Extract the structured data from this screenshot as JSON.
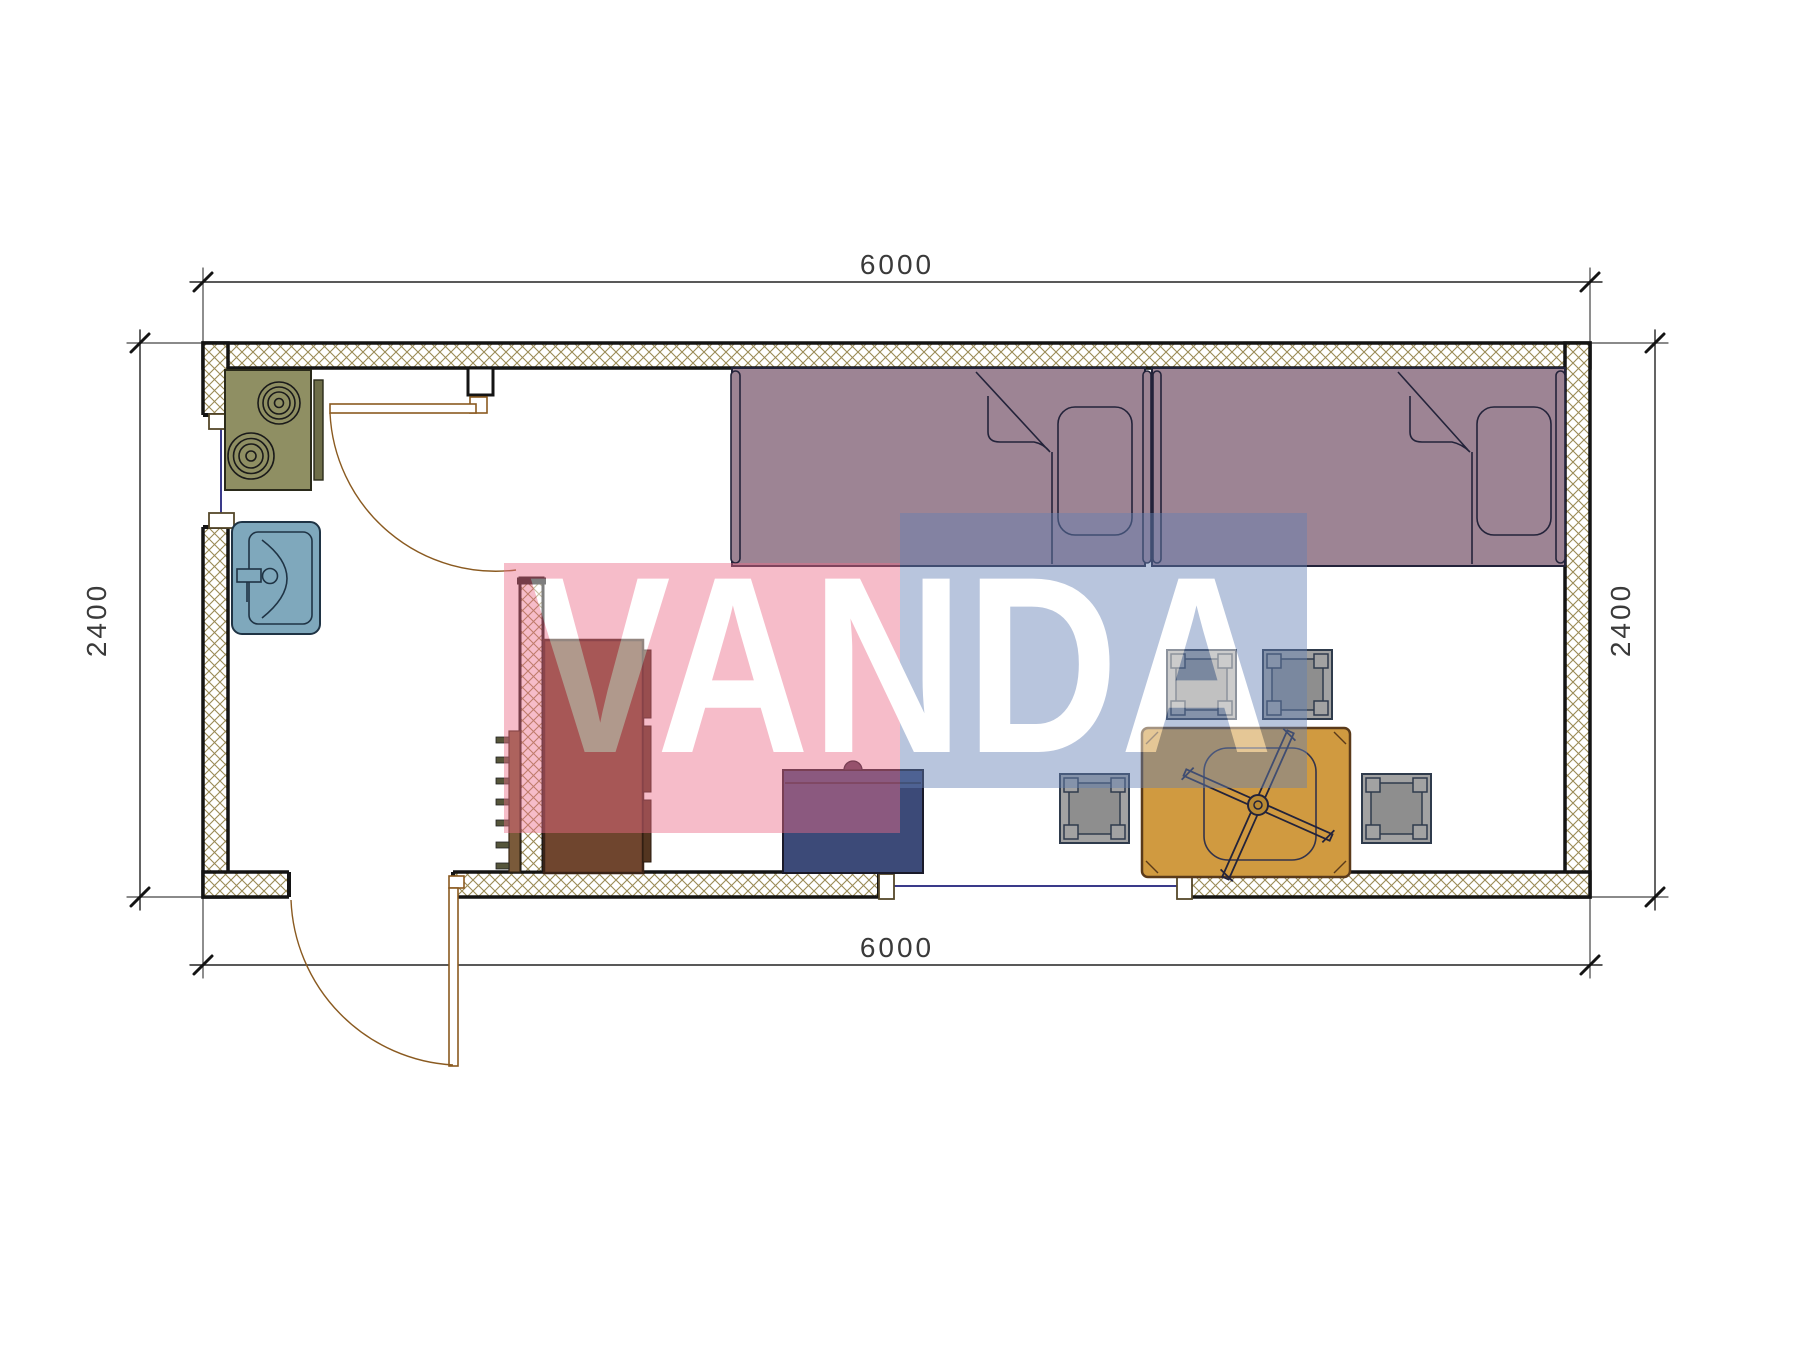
{
  "dimensions": {
    "top": "6000",
    "bottom": "6000",
    "left": "2400",
    "right": "2400"
  },
  "watermark": {
    "text": "VANDA",
    "pink_color": "#EC6D88",
    "blue_color": "#6481B4",
    "letter_color": "#FFFFFF",
    "opacity": "0.45"
  },
  "colors": {
    "wall_hatch": "#9A8A55",
    "wall_edge": "#141414",
    "bed": "#9D8494",
    "bed_line": "#23233A",
    "table": "#D09A40",
    "stool": "#A2A2A2",
    "sink": "#7FA8BC",
    "stove": "#8F8F63",
    "stove_panel": "#6E6E49",
    "wardrobe": "#6F452E",
    "wardrobe_rail": "#533520",
    "cabinet": "#3C4A78",
    "ladder_rail": "#7A5A3A",
    "ladder_rung": "#55553A",
    "door_line": "#8A5A20",
    "window_line": "#3A3A8A",
    "dimension_line": "#141414"
  }
}
